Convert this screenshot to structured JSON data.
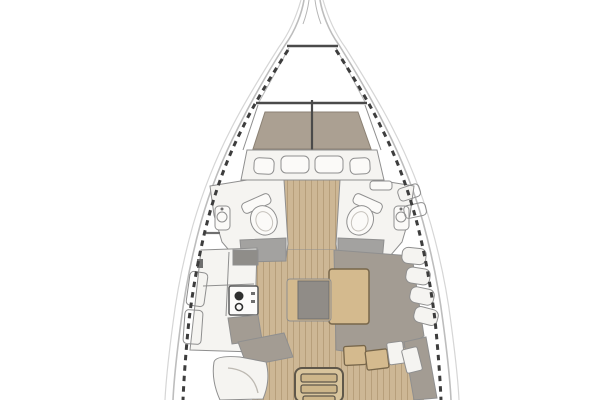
{
  "legend": {
    "diagram": "sailboat-interior-floor-plan",
    "areas": [
      "bow-pulpit",
      "anchor-locker",
      "v-berth-cabin",
      "forward-lockers",
      "port-head",
      "starboard-head",
      "galley",
      "salon",
      "l-settee",
      "salon-table",
      "center-bench",
      "nav-seat",
      "aft-steps",
      "companionway-ladder"
    ]
  },
  "palette": {
    "background": "#ffffff",
    "hull_line": "#bdbdbd",
    "hull_line_faint": "#d8d8d8",
    "toe_rail_dash": "#3d3d3d",
    "bulkhead_line": "#4a4a4a",
    "wall_line": "#8f8f8f",
    "white_surface": "#f5f4f1",
    "white_bright": "#fbfaf8",
    "mattress": "#aba092",
    "mattress_edge": "#8b8174",
    "plank_base": "#cdb795",
    "plank_stripe": "#b79f7b",
    "table_wood": "#d4ba8e",
    "table_edge": "#77664a",
    "settee_gray": "#a39c93",
    "cushion_gray": "#908c87",
    "counter_gray": "#8f8d89",
    "wet_floor_gray": "#a3a2a0",
    "ladder_wood": "#d8c49c",
    "ladder_edge": "#5f574a",
    "burner_dark": "#2f2f2f",
    "detail_dark": "#6f6f6f"
  }
}
